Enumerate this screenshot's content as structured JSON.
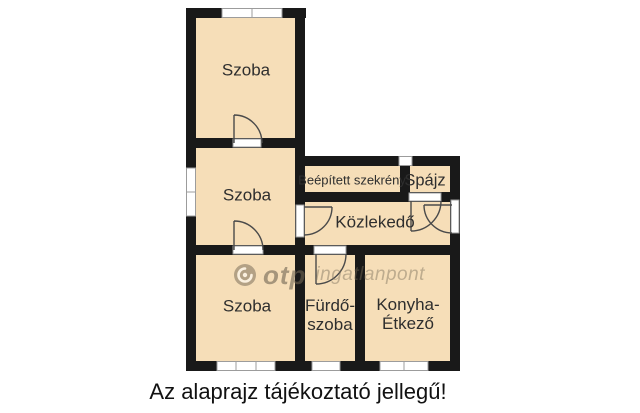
{
  "title": "floor-plan",
  "rooms": {
    "szoba_top": {
      "label": "Szoba"
    },
    "szoba_middle": {
      "label": "Szoba"
    },
    "szoba_bottom": {
      "label": "Szoba"
    },
    "wardrobe": {
      "label": "Beépített szekrény"
    },
    "pantry": {
      "label": "Spájz"
    },
    "hallway": {
      "label": "Közlekedő"
    },
    "bathroom": {
      "line1": "Fürdő-",
      "line2": "szoba"
    },
    "kitchen": {
      "line1": "Konyha-",
      "line2": "Étkező"
    }
  },
  "watermark": {
    "brand": "otp",
    "suffix": "ingatlanpont"
  },
  "caption": {
    "text": "Az alaprajz tájékoztató jellegű!"
  },
  "colors": {
    "floor": "#f6deb8",
    "wall": "#191919",
    "window_fill": "#ffffff",
    "window_border": "#9c9c9c",
    "door_swing": "#4a4a4a",
    "label_text": "#2e2e2e",
    "caption_text": "#111111"
  }
}
